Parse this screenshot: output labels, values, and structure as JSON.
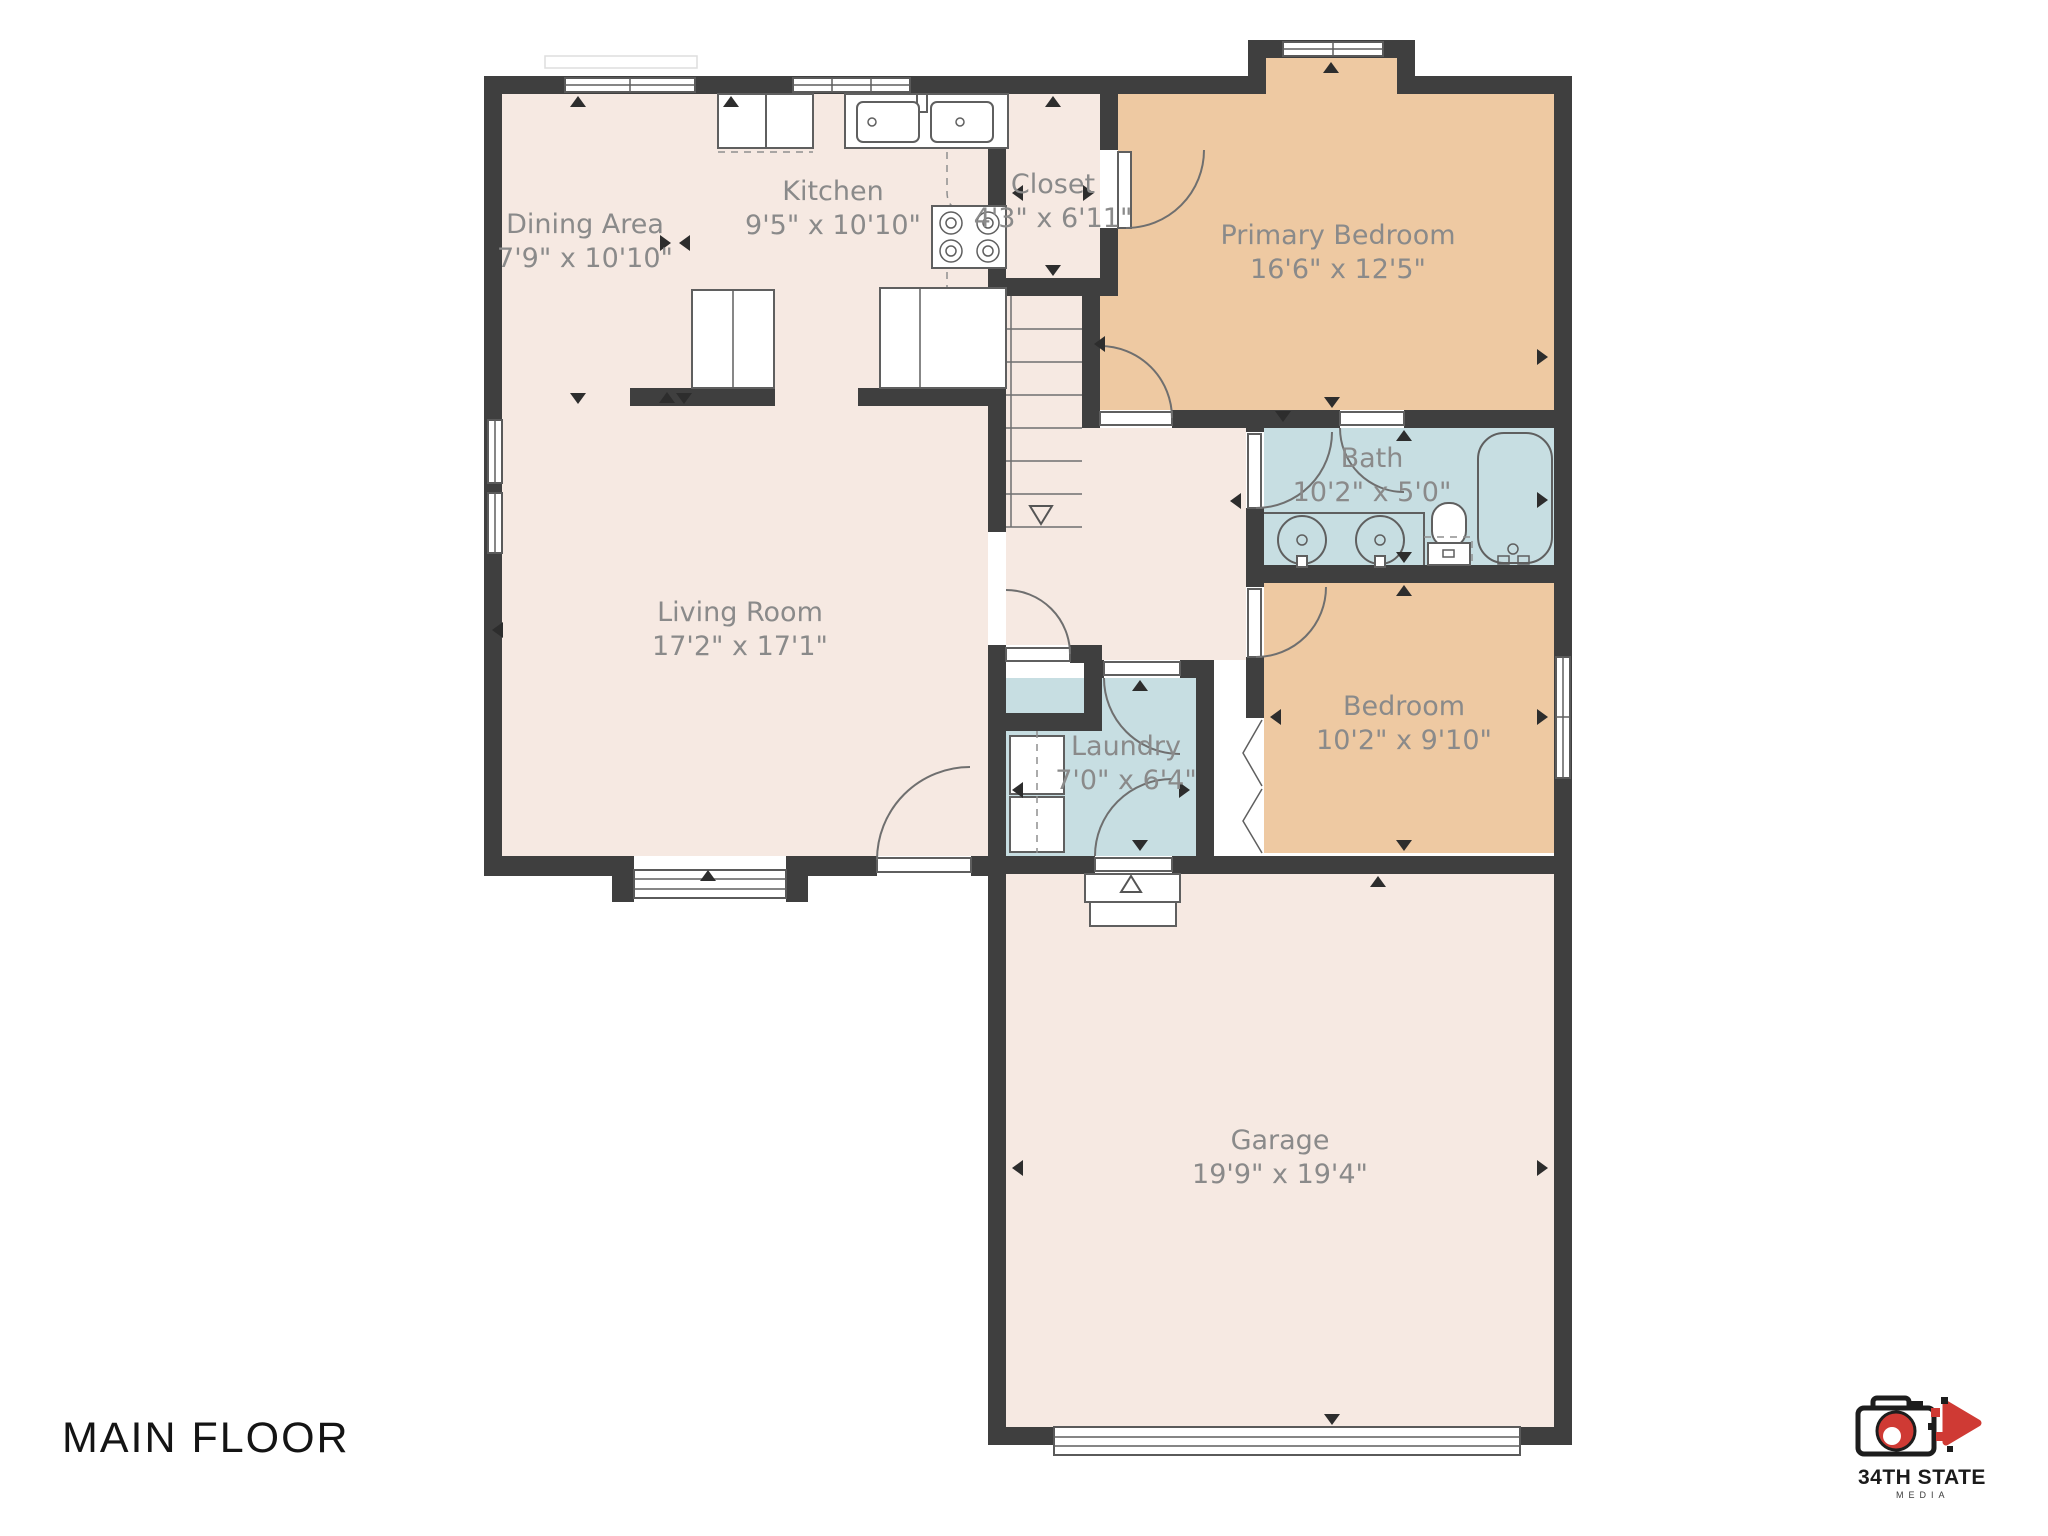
{
  "title": "MAIN FLOOR",
  "brand": {
    "name": "34TH STATE",
    "sub": "MEDIA",
    "icons": [
      "camera-icon",
      "play-icon"
    ]
  },
  "colors": {
    "wall": "#3f3f3f",
    "room": "#f6e9e2",
    "bedroom": "#eec9a2",
    "wet": "#c7dee2",
    "label": "#8a8a8a",
    "line": "#5f5f5f",
    "red": "#cf3a34"
  },
  "rooms": [
    {
      "id": "dining",
      "name": "Dining Area",
      "dims": "7'9\" x 10'10\""
    },
    {
      "id": "kitchen",
      "name": "Kitchen",
      "dims": "9'5\" x 10'10\""
    },
    {
      "id": "closet",
      "name": "Closet",
      "dims": "4'3\" x 6'11\""
    },
    {
      "id": "primary",
      "name": "Primary Bedroom",
      "dims": "16'6\" x 12'5\""
    },
    {
      "id": "bath",
      "name": "Bath",
      "dims": "10'2\" x 5'0\""
    },
    {
      "id": "living",
      "name": "Living Room",
      "dims": "17'2\" x 17'1\""
    },
    {
      "id": "laundry",
      "name": "Laundry",
      "dims": "7'0\" x 6'4\""
    },
    {
      "id": "bedroom",
      "name": "Bedroom",
      "dims": "10'2\" x 9'10\""
    },
    {
      "id": "garage",
      "name": "Garage",
      "dims": "19'9\" x 19'4\""
    }
  ]
}
